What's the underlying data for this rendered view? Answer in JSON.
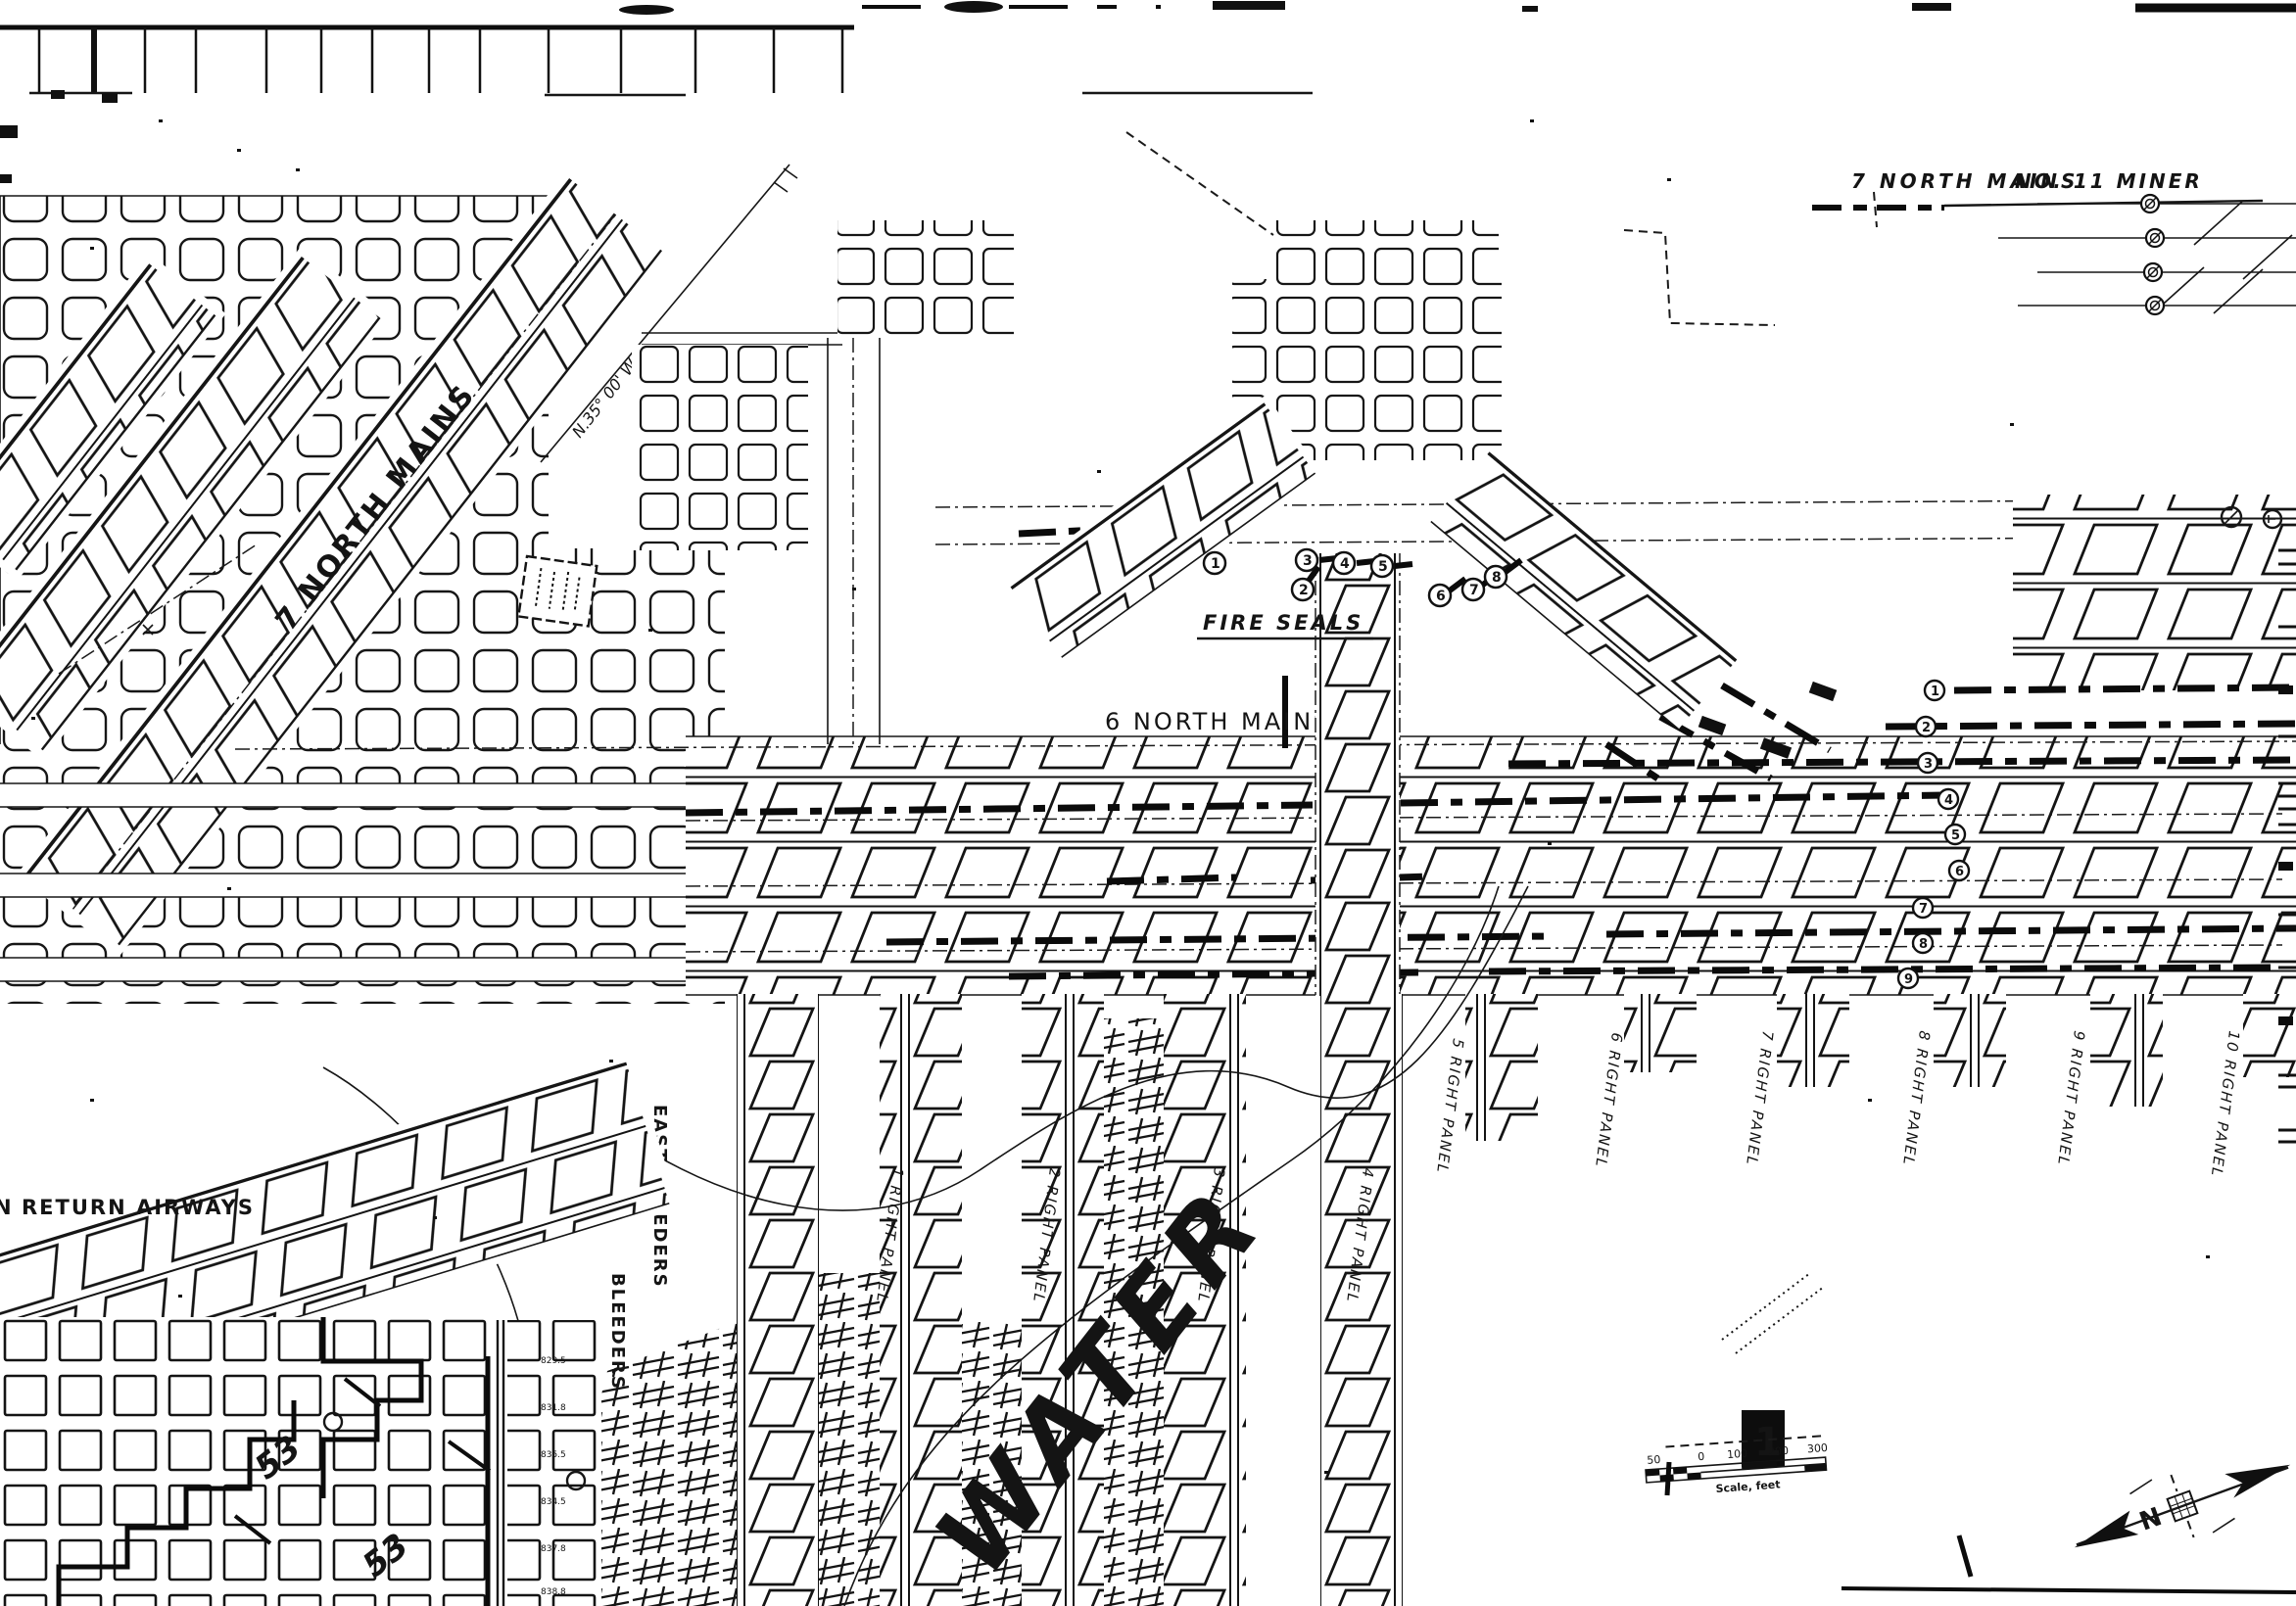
{
  "canvas": {
    "paper": "#ffffff",
    "ink": "#141414"
  },
  "labels": {
    "top_right_title_1": "7 NORTH MAINS",
    "top_right_title_2": "NO. 11 MINER",
    "seven_north_mains": "7 NORTH MAINS",
    "bearing": "N.35° 00' W",
    "six_north_mains": "6 NORTH MAINS",
    "fire_seals": "FIRE SEALS",
    "east_bleeders": "EAST BLEEDERS",
    "right_word": "RIGHT",
    "bleeders_word": "BLEEDERS",
    "return_airways": "RETURN AIRWAYS",
    "return_airways_fragment": "N"
  },
  "panel_labels": [
    "1 RIGHT PANEL",
    "2 RIGHT PANEL",
    "3 RIGHT PANEL",
    "4 RIGHT PANEL",
    "5 RIGHT PANEL",
    "6 RIGHT PANEL",
    "7 RIGHT PANEL",
    "8 RIGHT PANEL",
    "9 RIGHT PANEL",
    "10 RIGHT PANEL"
  ],
  "fire_seal_markers": [
    "1",
    "2",
    "3",
    "4",
    "5",
    "6",
    "7",
    "8"
  ],
  "entry_markers": [
    "1",
    "2",
    "3",
    "4",
    "5",
    "6",
    "7",
    "8",
    "9"
  ],
  "handwritten": {
    "water": "WATER",
    "mark_a": "53",
    "mark_b": "53"
  },
  "spot_elevations": [
    "829.5",
    "831.8",
    "835.5",
    "834.5",
    "837.8",
    "838.8"
  ],
  "legend": {
    "sheet_number": "1",
    "scale_ticks": [
      "50",
      "0",
      "100",
      "200",
      "300"
    ],
    "scale_caption": "Scale, feet",
    "north_label": "N"
  }
}
